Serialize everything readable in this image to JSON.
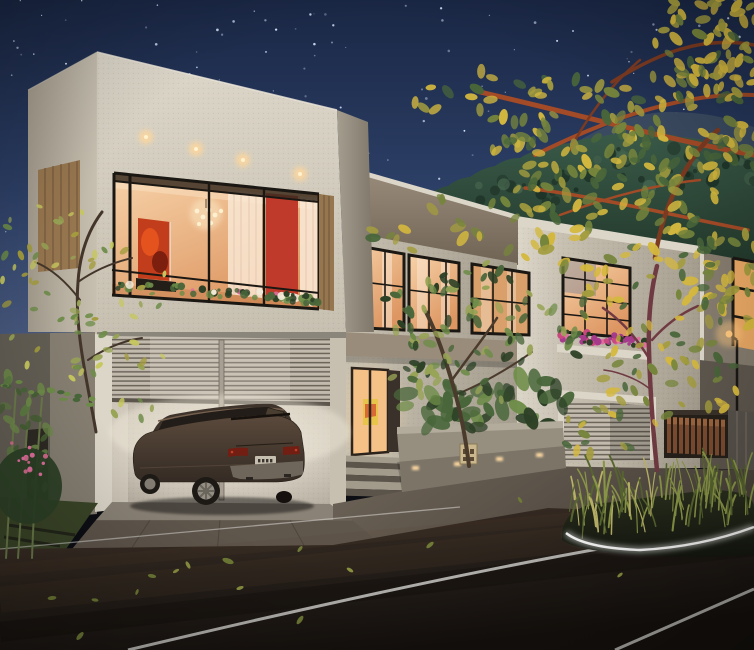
{
  "canvas": {
    "width": 754,
    "height": 650
  },
  "scene": {
    "subject": "night-render-modern-villas-street",
    "elements": [
      "starry-sky",
      "forested-hill",
      "main-villa",
      "corner-picture-window",
      "garage-with-suv",
      "entrance-door",
      "planter-box",
      "neighbor-villa",
      "wood-fence",
      "street-road",
      "landscaped-median",
      "yellow-leaf-tree"
    ]
  },
  "palette": {
    "sky_top": "#1a2745",
    "sky_mid": "#2c3f66",
    "sky_low": "#46587e",
    "sky_horizon": "#5b6a8d",
    "star": "#dce8ff",
    "ridge_far": "#3d4d61",
    "hill_top": "#3a5a48",
    "hill_bottom": "#1e3226",
    "hill_dot_dark": "#16281e",
    "hill_dot_light": "#4a6a52",
    "wall_bright": "#dcd6c9",
    "wall_mid": "#c7c0b1",
    "wall_shade": "#a59d8e",
    "wall_dark": "#7e776a",
    "fascia": "#9a8c7b",
    "fascia_dark": "#6f6354",
    "mullion": "#1b1713",
    "glass_warm": "#f7d3a9",
    "glass_deep": "#dd9662",
    "curtain": "#f9e7d4",
    "red_wall": "#bf3a2a",
    "painting": "#c23d1c",
    "painting_dark": "#7d1f0e",
    "chandelier": "#fff1cf",
    "wood": "#96764f",
    "wood_dark": "#6e5438",
    "downlight": "#ffd79b",
    "shutter_hi": "#c2baad",
    "shutter_line": "#6c655a",
    "garage_glow": "#f3ede0",
    "garage_floor": "#8a8276",
    "car_body": "#5b4a3c",
    "car_dark": "#342b24",
    "car_glass": "#221d18",
    "car_seat": "#d3c6ad",
    "car_tail": "#731e12",
    "car_tail_hi": "#c0402a",
    "car_plate": "#c6bfb0",
    "car_bumper": "#6e665a",
    "car_tire": "#1d1915",
    "car_alloy": "#948e84",
    "door_glow": "#f5c187",
    "door_frame": "#2c231b",
    "door_art": "#e8c44a",
    "step_light": "#a29a8b",
    "step_dark": "#5b544b",
    "planter_wall": "#968e7e",
    "planter_rim": "#b3ab9c",
    "planter_light": "#ffd9a2",
    "leaf_green_dark": "#2c4026",
    "leaf_green": "#49663a",
    "leaf_green_light": "#6d8c48",
    "leaf_warm": "#97a355",
    "leaf_yellow": "#d4b83e",
    "leaf_olive": "#a39c3e",
    "leaf_tree_green": "#76853c",
    "branch": "#a34a27",
    "branch_dark": "#7c3a20",
    "trunk_maroon": "#6f3a42",
    "trunk_dark": "#43352a",
    "flower_pink": "#c9487e",
    "flower_magenta": "#a63a8b",
    "flower_light": "#e06f9f",
    "grass_blade": "#8a9647",
    "grass_dark": "#57652f",
    "grass_light": "#b9b267",
    "ground_grass": "#3a4527",
    "pavement": "#6e6458",
    "pavement_dark": "#4a433b",
    "driveway": "#5f564c",
    "road_warm": "#4a3a2e",
    "road_mid": "#261f1a",
    "road_dark": "#14100d",
    "lane": "#d9d9d6",
    "curb_glow": "#ffffff",
    "fence_bg": "#262019",
    "fence_picket": "#7d4c30",
    "fence_picket_hi": "#a66a42",
    "far_wall": "#857c6e",
    "far_window": "#e9a864",
    "lamp_glow": "#ffc87e",
    "road_leaf": "#8a9140",
    "road_leaf_dark": "#6e7a35"
  },
  "generation": {
    "seed": 7,
    "stars": 130,
    "hill_dots": 64,
    "big_tree_leaves": 330,
    "right_tree_leaves": 85,
    "center_tree_leaves": 95,
    "left_tree_leaves": 72,
    "planter_leaves": 42,
    "garland_leaves": 60,
    "neighbor_flowers": 48,
    "median_grass": 95,
    "road_leaves": 15,
    "bamboo_leaves": 26,
    "shrub_flowers": 14,
    "creeper_leaves": 16
  }
}
